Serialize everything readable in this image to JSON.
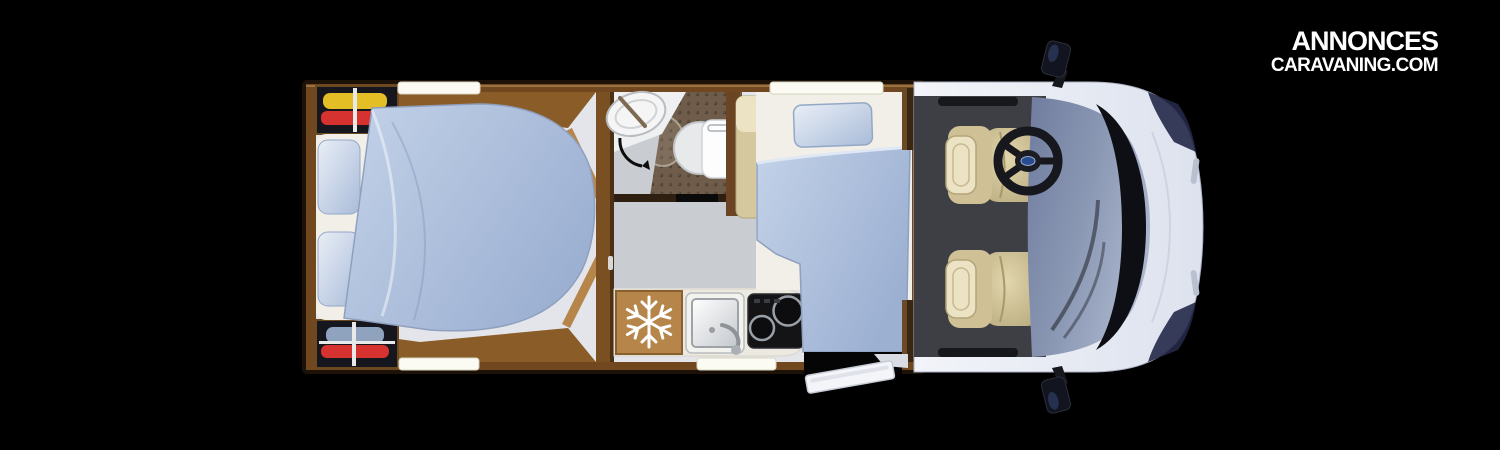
{
  "logo": {
    "line1": "ANNONCES",
    "line2": "CARAVANING.COM"
  },
  "icons": {
    "fridge_badge": "snowflake-icon",
    "steering_hub_badge": "brand-oval-badge",
    "bathroom_door": "door-swing-arc-icon"
  },
  "colors": {
    "background": "#000000",
    "logo": "#ffffff",
    "wood": "#70471f",
    "wood_dark": "#3a2712",
    "wood_light": "#b5854a",
    "wood_band": "#8a5c28",
    "floor": "#e3e5ea",
    "floor_dim": "#c9ccd1",
    "cab_floor": "#3d3f44",
    "sheet": "#f1efe8",
    "bedding": "#b7c7e1",
    "bedding_deep": "#9cb0d2",
    "wardrobe_bg": "#16161e",
    "cloth_yellow": "#e3bf25",
    "cloth_red": "#d63230",
    "cloth_blue": "#8fa3bf",
    "shower_floor": "#6f5c4a",
    "porcelain": "#eef0f2",
    "counter": "#ece9e1",
    "stove": "#141417",
    "burner_ring": "#9aa0a8",
    "seat": "#d6c89e",
    "seat_light": "#ece2c4",
    "body_light": "#f2f4f9",
    "body_shade": "#dde2ee",
    "glass_light": "#aab5cc",
    "glass_deep": "#6f7c9e",
    "cowl": "#0d0f14",
    "window_bar": "#fbfbf4",
    "headlight": "#232848"
  }
}
